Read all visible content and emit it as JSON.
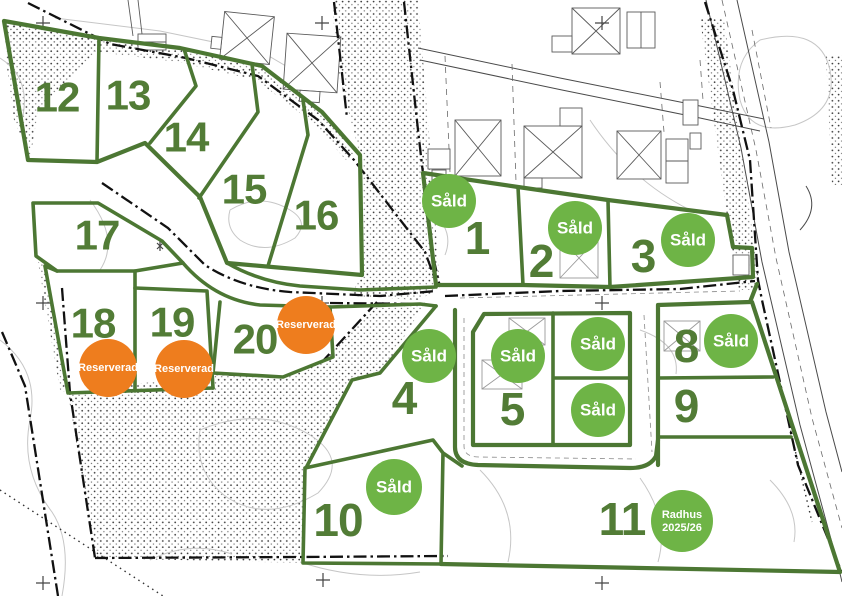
{
  "map": {
    "description": "Tomtkarta – plot sales plan",
    "sold_count": 9,
    "reserved_count": 3
  },
  "colors": {
    "plot_line": "#4c7733",
    "plot_number": "#527c36",
    "sold": "#6eb446",
    "reserved": "#ee7d1e",
    "badge_text": "#ffffff"
  },
  "labels": {
    "sold": "Såld",
    "reserved": "Reserverad",
    "townhouse_line1": "Radhus",
    "townhouse_line2": "2025/26"
  },
  "plots": [
    {
      "number": "1",
      "status": "sold",
      "number_x": 477,
      "number_y": 238,
      "number_size": 46,
      "badge_x": 449,
      "badge_y": 201,
      "badge_r": 27
    },
    {
      "number": "2",
      "status": "sold",
      "number_x": 541,
      "number_y": 261,
      "number_size": 46,
      "badge_x": 575,
      "badge_y": 228,
      "badge_r": 27
    },
    {
      "number": "3",
      "status": "sold",
      "number_x": 643,
      "number_y": 256,
      "number_size": 46,
      "badge_x": 688,
      "badge_y": 240,
      "badge_r": 27
    },
    {
      "number": "4",
      "status": "sold",
      "number_x": 404,
      "number_y": 398,
      "number_size": 46,
      "badge_x": 429,
      "badge_y": 356,
      "badge_r": 27
    },
    {
      "number": "5",
      "status": "sold",
      "number_x": 512,
      "number_y": 409,
      "number_size": 46,
      "badge_x": 518,
      "badge_y": 356,
      "badge_r": 27
    },
    {
      "number": "",
      "status": "sold",
      "badge_x": 598,
      "badge_y": 344,
      "badge_r": 27
    },
    {
      "number": "",
      "status": "sold",
      "badge_x": 598,
      "badge_y": 410,
      "badge_r": 27
    },
    {
      "number": "8",
      "status": "sold",
      "number_x": 686,
      "number_y": 346,
      "number_size": 46,
      "badge_x": 731,
      "badge_y": 341,
      "badge_r": 27
    },
    {
      "number": "9",
      "status": "available",
      "number_x": 686,
      "number_y": 406,
      "number_size": 46
    },
    {
      "number": "10",
      "status": "sold",
      "number_x": 338,
      "number_y": 520,
      "number_size": 46,
      "badge_x": 394,
      "badge_y": 487,
      "badge_r": 28
    },
    {
      "number": "11",
      "status": "townhouse",
      "number_x": 622,
      "number_y": 519,
      "number_size": 46,
      "badge_x": 682,
      "badge_y": 521,
      "badge_r": 31
    },
    {
      "number": "12",
      "status": "available",
      "number_x": 57,
      "number_y": 97,
      "number_size": 42
    },
    {
      "number": "13",
      "status": "available",
      "number_x": 128,
      "number_y": 95,
      "number_size": 42
    },
    {
      "number": "14",
      "status": "available",
      "number_x": 186,
      "number_y": 137,
      "number_size": 42
    },
    {
      "number": "15",
      "status": "available",
      "number_x": 244,
      "number_y": 189,
      "number_size": 42
    },
    {
      "number": "16",
      "status": "available",
      "number_x": 316,
      "number_y": 215,
      "number_size": 42
    },
    {
      "number": "17",
      "status": "available",
      "number_x": 97,
      "number_y": 235,
      "number_size": 42
    },
    {
      "number": "18",
      "status": "reserved",
      "number_x": 93,
      "number_y": 323,
      "number_size": 42,
      "badge_x": 108,
      "badge_y": 368,
      "badge_r": 29
    },
    {
      "number": "19",
      "status": "reserved",
      "number_x": 172,
      "number_y": 322,
      "number_size": 42,
      "badge_x": 184,
      "badge_y": 369,
      "badge_r": 29
    },
    {
      "number": "20",
      "status": "reserved",
      "number_x": 255,
      "number_y": 339,
      "number_size": 42,
      "badge_x": 306,
      "badge_y": 325,
      "badge_r": 29
    }
  ]
}
